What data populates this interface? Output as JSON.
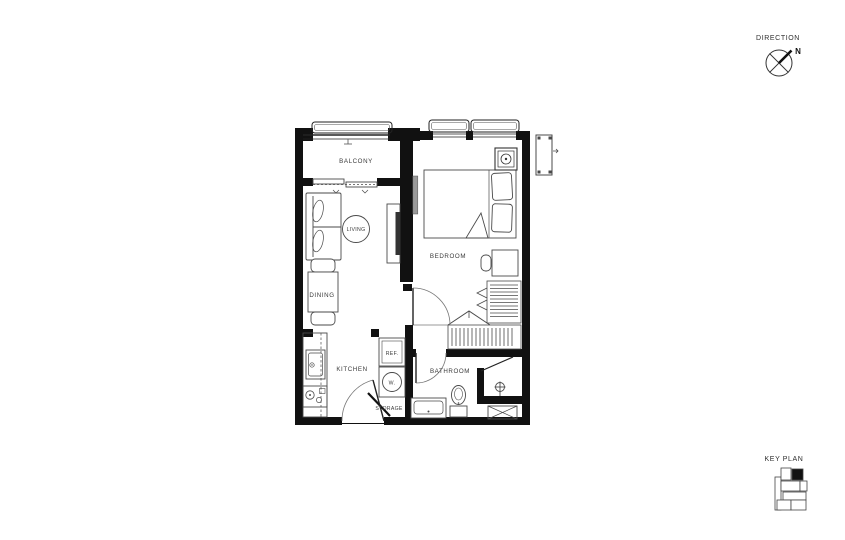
{
  "labels": {
    "balcony": "BALCONY",
    "living": "LIVING",
    "dining": "DINING",
    "kitchen": "KITCHEN",
    "bedroom": "BEDROOM",
    "bathroom": "BATHROOM",
    "storage": "STORAGE",
    "fridge": "REF.",
    "washer": "W."
  },
  "direction": {
    "title": "DIRECTION",
    "north_label": "N"
  },
  "key_plan": {
    "title": "KEY PLAN"
  },
  "colors": {
    "wall": "#111111",
    "furniture_line": "#4a4a4a",
    "label_text": "#3a3a3a",
    "background": "#ffffff",
    "keyplan_highlight": "#111111"
  }
}
